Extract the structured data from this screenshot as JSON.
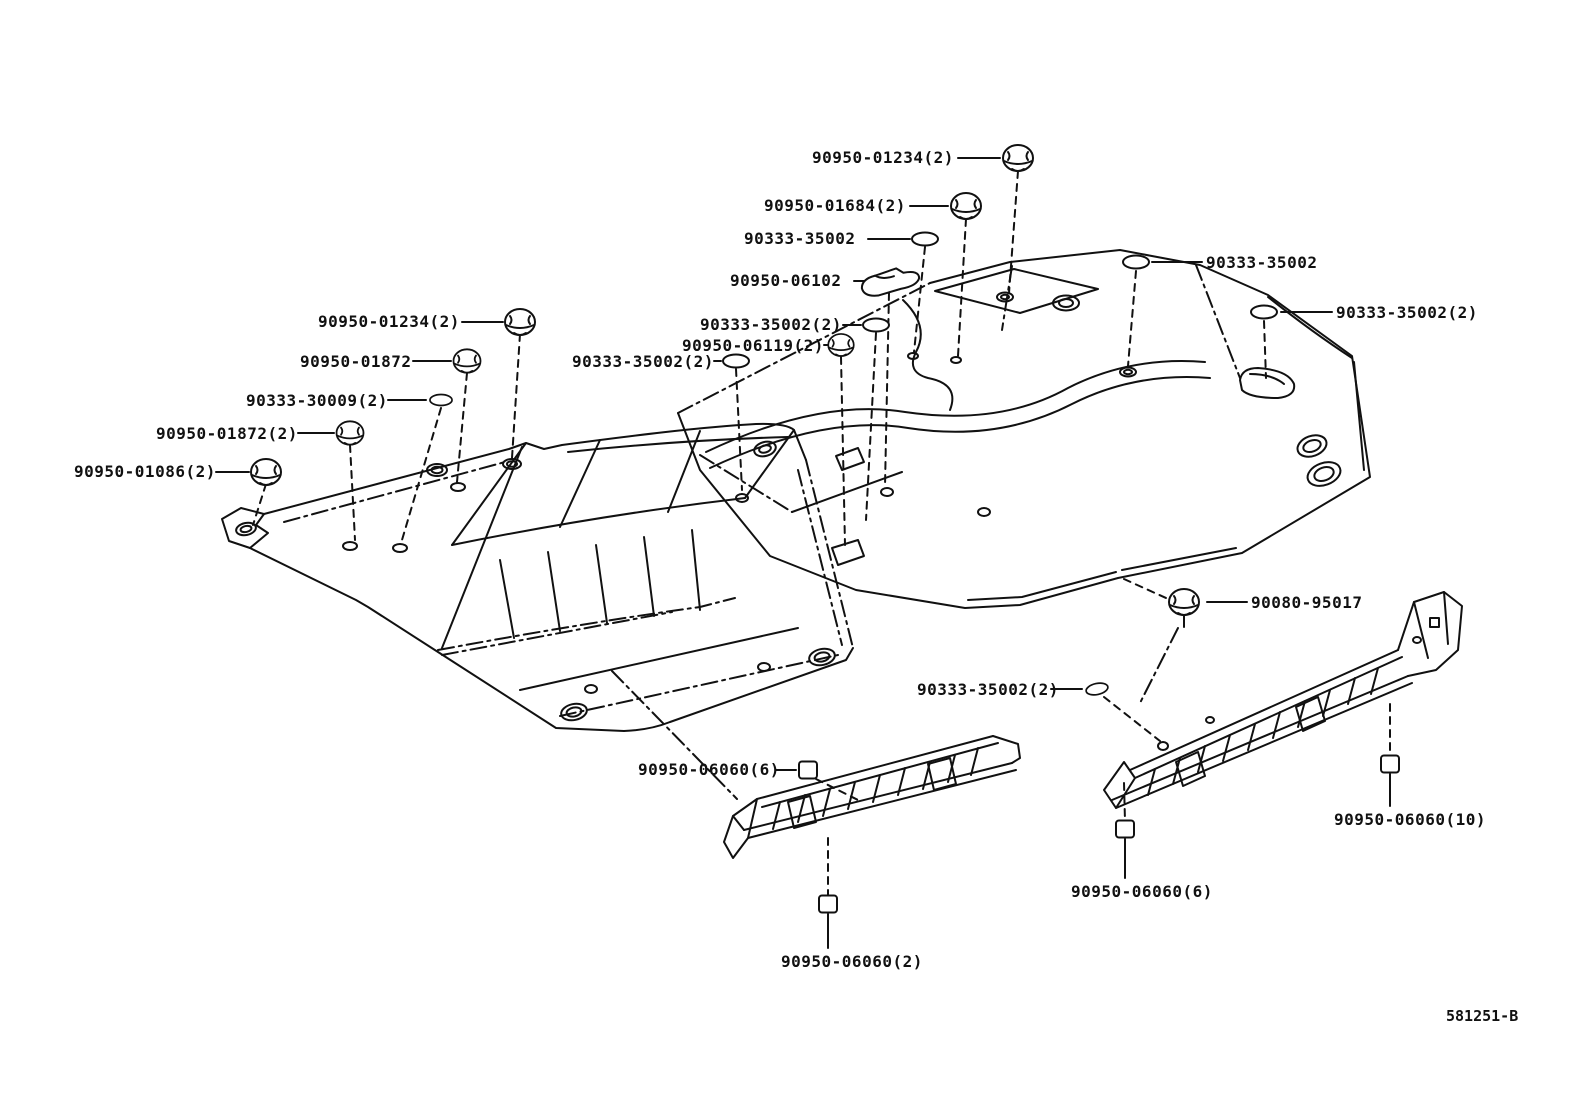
{
  "diagram": {
    "type": "parts-catalog-exploded-view",
    "subject": "floor silencer pads and rocker silencer strips with fastener plugs and clips",
    "code": "581251-B",
    "line_color": "#111111",
    "background": "#ffffff"
  },
  "labels": [
    {
      "id": "top-01234",
      "text": "90950-01234(2)",
      "icon": "grommet-plug"
    },
    {
      "id": "top-01684",
      "text": "90950-01684(2)",
      "icon": "grommet-plug"
    },
    {
      "id": "top-35002",
      "text": "90333-35002",
      "icon": "oval-washer"
    },
    {
      "id": "top-06102",
      "text": "90950-06102",
      "icon": "flat-pad"
    },
    {
      "id": "mid-35002a",
      "text": "90333-35002(2)",
      "icon": "oval-washer"
    },
    {
      "id": "mid-06119",
      "text": "90950-06119(2)",
      "icon": "grommet-plug"
    },
    {
      "id": "mid-35002b",
      "text": "90333-35002(2)",
      "icon": "oval-washer"
    },
    {
      "id": "left-01234",
      "text": "90950-01234(2)",
      "icon": "grommet-plug"
    },
    {
      "id": "left-01872",
      "text": "90950-01872",
      "icon": "grommet-plug"
    },
    {
      "id": "left-30009",
      "text": "90333-30009(2)",
      "icon": "oval-washer"
    },
    {
      "id": "left-01872-2",
      "text": "90950-01872(2)",
      "icon": "grommet-plug"
    },
    {
      "id": "left-01086",
      "text": "90950-01086(2)",
      "icon": "grommet-plug"
    },
    {
      "id": "right-35002",
      "text": "90333-35002",
      "icon": "oval-washer"
    },
    {
      "id": "right-35002-2",
      "text": "90333-35002(2)",
      "icon": "oval-washer"
    },
    {
      "id": "mid-95017",
      "text": "90080-95017",
      "icon": "grommet-plug"
    },
    {
      "id": "bot-35002",
      "text": "90333-35002(2)",
      "icon": "oval-washer"
    },
    {
      "id": "bot-06060-6L",
      "text": "90950-06060(6)",
      "icon": "square-clip"
    },
    {
      "id": "bot-06060-2",
      "text": "90950-06060(2)",
      "icon": "square-clip"
    },
    {
      "id": "bot-06060-6R",
      "text": "90950-06060(6)",
      "icon": "square-clip"
    },
    {
      "id": "bot-06060-10",
      "text": "90950-06060(10)",
      "icon": "square-clip"
    }
  ],
  "icons": {
    "grommet-plug": "round push-in plug (circle with cap slot)",
    "oval-washer": "small flat oval grommet",
    "flat-pad": "flat elongated silencer pad",
    "square-clip": "small square retainer clip"
  }
}
